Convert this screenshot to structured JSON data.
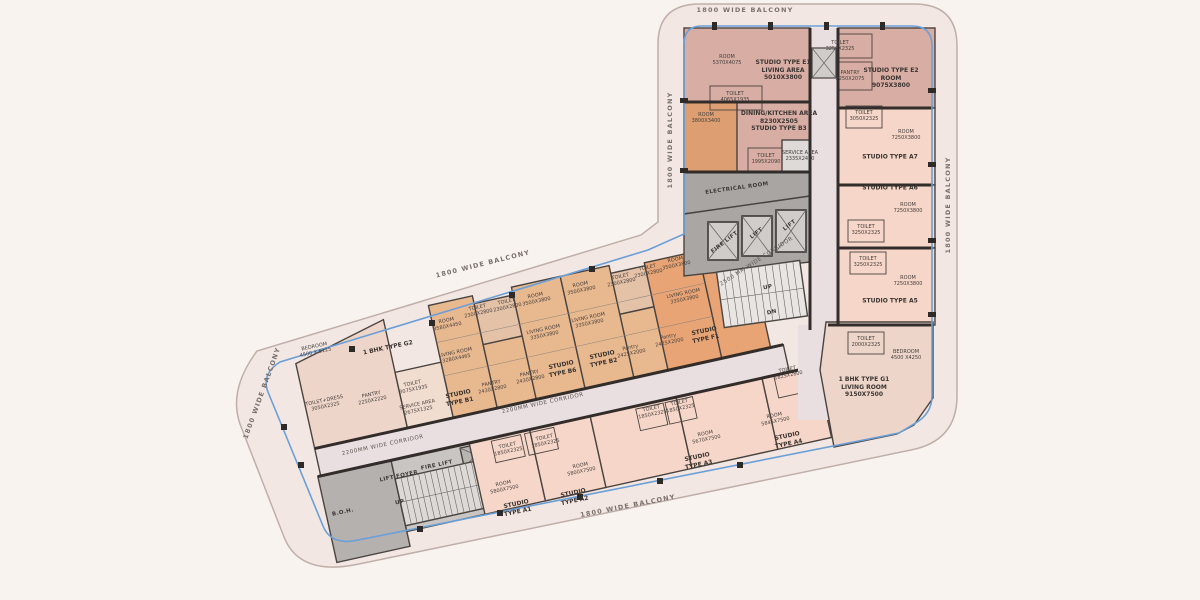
{
  "title": "Residential floor plan",
  "colors": {
    "background": "#f9f3f0",
    "balcony_band": "#f2e7e2",
    "balcony_line_blue": "#6a9fd8",
    "wall": "#3e3936",
    "unit_mauve": "#d8ada4",
    "unit_tan": "#e8b88f",
    "unit_orange": "#e8a474",
    "unit_orange_room": "#dd9f72",
    "unit_pink": "#f6d6c8",
    "unit_beige": "#edd5c9",
    "corridor": "#e9dee0",
    "core_dark": "#a8a5a3",
    "core_mid": "#b4b1af",
    "core_light": "#d9d6d4"
  },
  "labels": {
    "balcony": "1800 WIDE BALCONY",
    "corridor_2500": "2500 MM WIDE CORRIDOR",
    "corridor_2200": "2200MM WIDE CORRIDOR",
    "electrical_room": "ELECTRICAL ROOM",
    "fire_lift": "FIRE LIFT",
    "lift": "LIFT",
    "lift_foyer": "LIFT FOYER",
    "boh": "B.O.H.",
    "up": "UP",
    "dn": "DN",
    "e1": "STUDIO TYPE E1\nLIVING AREA\n5010X3800",
    "e1_room": "ROOM\n5370X4075",
    "e1_toilet": "TOILET\n4065X1935",
    "e2": "STUDIO TYPE E2\nROOM\n9075X3800",
    "e2_pantry": "PANTRY\n2250X2075",
    "toilet_3250": "TOILET\n3250X2325",
    "b3": "DINING/KITCHEN AREA\n8230X2505\nSTUDIO TYPE B3",
    "b3_room": "ROOM\n3800X3400",
    "b3_toilet": "TOILET\n1995X2090",
    "b3_service": "SERVICE AREA\n2335X2400",
    "a7": "STUDIO TYPE A7",
    "a7_toilet": "TOILET\n3050X2325",
    "room_7250": "ROOM\n7250X3800",
    "a6": "STUDIO TYPE A6",
    "a5": "STUDIO TYPE A5",
    "g1": "1 BHK TYPE G1\nLIVING ROOM\n9150X7500",
    "g1_toilet": "TOILET\n2000X2325",
    "g1_bedroom": "BEDROOM\n4500 X4250",
    "g2": "1 BHK TYPE G2",
    "g2_bedroom": "BEDROOM\n4500 X 5125",
    "g2_toilet_dress": "TOILET+DRESS\n3050X2325",
    "g2_pantry": "PANTRY\n2250X2220",
    "svc_toilet": "TOILET\n3075X1935",
    "svc_area": "SERVICE AREA\n2675X1325",
    "b1": "STUDIO\nTYPE B1",
    "b1_room": "ROOM\n3580X4450",
    "b1_living": "LIVING ROOM\n3280X4465",
    "pantry_2430": "PANTRY\n2430X2800",
    "toilet_2300": "TOILET\n2300X2800",
    "b6": "STUDIO\nTYPE B6",
    "room_3500": "ROOM\n3500X3800",
    "living_3350": "LIVING ROOM\n3350X3800",
    "b2": "STUDIO\nTYPE B2",
    "pantry_2425": "Pantry\n2425X2000",
    "f1": "STUDIO\nTYPE F1",
    "a1": "STUDIO\nTYPE A1",
    "room_5800": "ROOM\n5800X7500",
    "toilet_1850": "TOILET\n1850X2325",
    "a2": "STUDIO\nTYPE A2",
    "a3": "STUDIO\nTYPE A3",
    "a3_room": "ROOM\n5670X7500",
    "a4": "STUDIO\nTYPE A4",
    "a4_room": "ROOM\n5845X7500",
    "a4_toilet": "TOILET\n1825X2800"
  }
}
